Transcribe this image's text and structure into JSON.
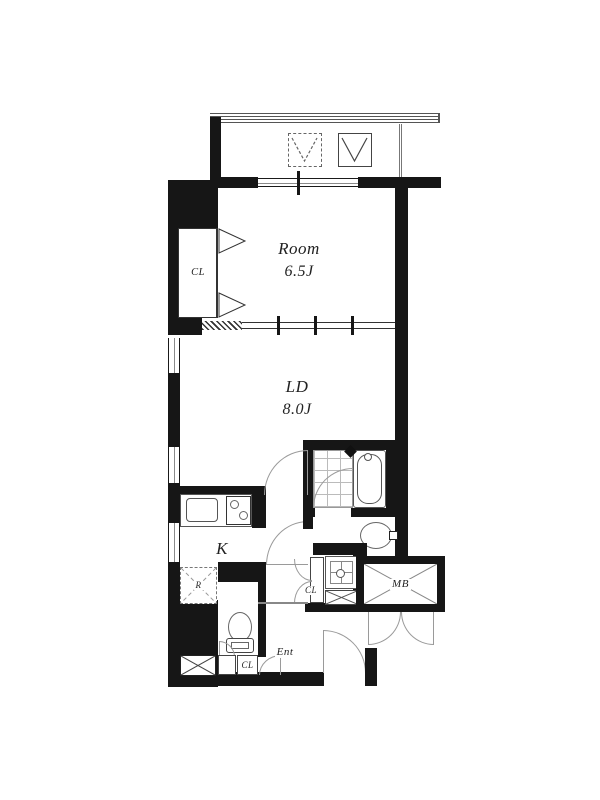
{
  "floorplan": {
    "rooms": {
      "main_room": {
        "name": "Room",
        "size": "6.5J"
      },
      "living_dining": {
        "name": "LD",
        "size": "8.0J"
      },
      "kitchen": {
        "name": "K"
      },
      "entrance": {
        "name": "Ent"
      }
    },
    "storage": {
      "bedroom_closet": "CL",
      "hall_closet": "CL",
      "entrance_closet": "CL",
      "refrigerator_space": "R",
      "meter_box": "MB"
    },
    "colors": {
      "wall": "#161616",
      "fixture_line": "#666666",
      "door_arc": "#9a9a9a",
      "tile_line": "#bbbbbb"
    }
  }
}
